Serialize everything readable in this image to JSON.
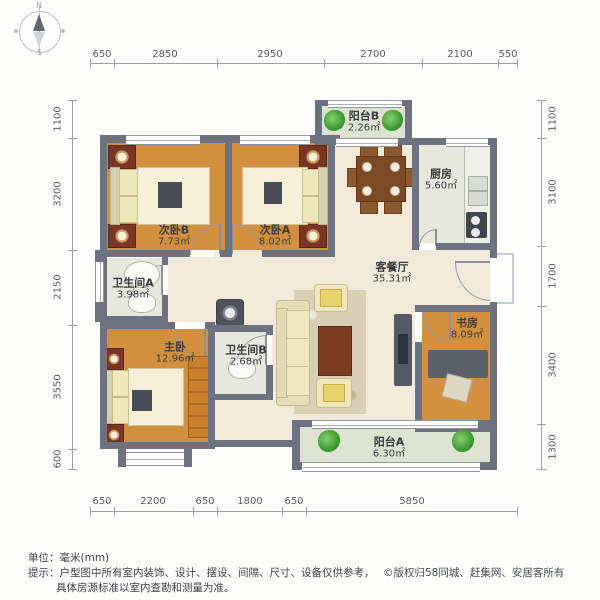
{
  "compass": {
    "north": "N",
    "south": "S"
  },
  "dims": {
    "top": [
      "650",
      "2850",
      "2950",
      "2700",
      "2100",
      "550"
    ],
    "bottom": [
      "650",
      "2200",
      "650",
      "1800",
      "650",
      "5850"
    ],
    "left": [
      "1100",
      "3200",
      "2150",
      "3550",
      "600"
    ],
    "right": [
      "1100",
      "3100",
      "1700",
      "3400",
      "1300"
    ]
  },
  "rooms": {
    "balcony_b": {
      "name": "阳台B",
      "area": "2.26㎡"
    },
    "bedroom_b": {
      "name": "次卧B",
      "area": "7.73㎡"
    },
    "bedroom_a": {
      "name": "次卧A",
      "area": "8.02㎡"
    },
    "kitchen": {
      "name": "厨房",
      "area": "5.60㎡"
    },
    "living": {
      "name": "客餐厅",
      "area": "35.31㎡"
    },
    "bathroom_a": {
      "name": "卫生间A",
      "area": "3.98㎡"
    },
    "master": {
      "name": "主卧",
      "area": "12.96㎡"
    },
    "bathroom_b": {
      "name": "卫生间B",
      "area": "2.68㎡"
    },
    "study": {
      "name": "书房",
      "area": "8.09㎡"
    },
    "balcony_a": {
      "name": "阳台A",
      "area": "6.30㎡"
    }
  },
  "footer": {
    "unit": "单位：毫米(mm)",
    "tip": "提示：户型图中所有室内装饰、设计、摆设、间隔、尺寸、设备仅供参考，",
    "copyright": "©版权归58同城、赶集网、安居客所有",
    "tip2": "具体房源标准以室内查勘和测量为准。"
  },
  "colors": {
    "wall": "#6d7280",
    "wood_floor": "#d28f3e",
    "living_floor": "#f1e9d9",
    "tile_floor": "#e6e8db",
    "balcony_floor": "#dde3d1",
    "plant_green": "#3c9a33",
    "accent_red": "#7a3526"
  }
}
